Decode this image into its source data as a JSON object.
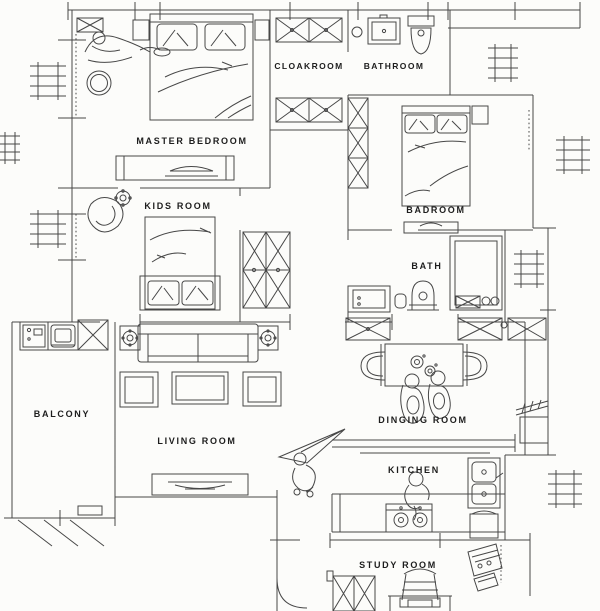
{
  "document": {
    "type": "apartment floor plan CAD drawing",
    "style": "black line work on white paper"
  },
  "colors": {
    "background": "#fcfcfa",
    "wall_line": "#1f1f1f",
    "furniture_line": "#474747",
    "thin_line": "#8b8b8b",
    "label_text": "#1d1d1d"
  },
  "rooms": [
    {
      "id": "master-bedroom",
      "label": "MASTER BEDROOM",
      "furniture": [
        "double-bed",
        "nightstand",
        "nightstand",
        "lounging-person-figure",
        "round-stool",
        "air-conditioner-x-unit",
        "bench-dresser"
      ]
    },
    {
      "id": "cloakroom",
      "label": "CLOAKROOM",
      "furniture": [
        "wardrobe-x",
        "wardrobe-x"
      ]
    },
    {
      "id": "bathroom",
      "label": "BATHROOM",
      "furniture": [
        "wash-basin",
        "toilet",
        "round-drain"
      ]
    },
    {
      "id": "badroom",
      "label": "BADROOM",
      "furniture": [
        "double-bed",
        "nightstand",
        "closet-x-strip",
        "bench"
      ]
    },
    {
      "id": "kids-room",
      "label": "KIDS ROOM",
      "furniture": [
        "single-bed",
        "round-chair",
        "flower-stool",
        "wardrobe-x-4cell"
      ]
    },
    {
      "id": "bath",
      "label": "BATH",
      "furniture": [
        "vanity-basin",
        "toilet",
        "shower-cabin",
        "waste-bin",
        "drain-mat-x"
      ]
    },
    {
      "id": "balcony",
      "label": "BALCONY",
      "furniture": [
        "laundry-sink",
        "washing-machine",
        "cabinet-x",
        "planter"
      ]
    },
    {
      "id": "living-room",
      "label": "LIVING ROOM",
      "furniture": [
        "sofa",
        "coffee-table",
        "armchair",
        "armchair",
        "side-table-flower",
        "side-table-flower",
        "tv-console",
        "paper-plane",
        "person-figure"
      ]
    },
    {
      "id": "dinging-room",
      "label": "DINGING ROOM",
      "furniture": [
        "dining-table",
        "dining-chair",
        "dining-chair",
        "seated-person-figure",
        "seated-person-figure",
        "table-flowers"
      ]
    },
    {
      "id": "kitchen",
      "label": "KITCHEN",
      "furniture": [
        "bar-counter",
        "gas-stove",
        "kitchen-sink",
        "cooking-person-figure",
        "service-cart",
        "counter-run"
      ]
    },
    {
      "id": "study-room",
      "label": "STUDY ROOM",
      "furniture": [
        "bookshelf-x",
        "study-chair",
        "study-desk-keyboard",
        "drafting-table"
      ]
    }
  ],
  "exterior_symbols": [
    "radiator-grille",
    "radiator-grille",
    "radiator-grille",
    "radiator-grille",
    "radiator-grille",
    "radiator-grille",
    "radiator-grille",
    "window-hatch",
    "door-swing",
    "grid-ticks"
  ]
}
